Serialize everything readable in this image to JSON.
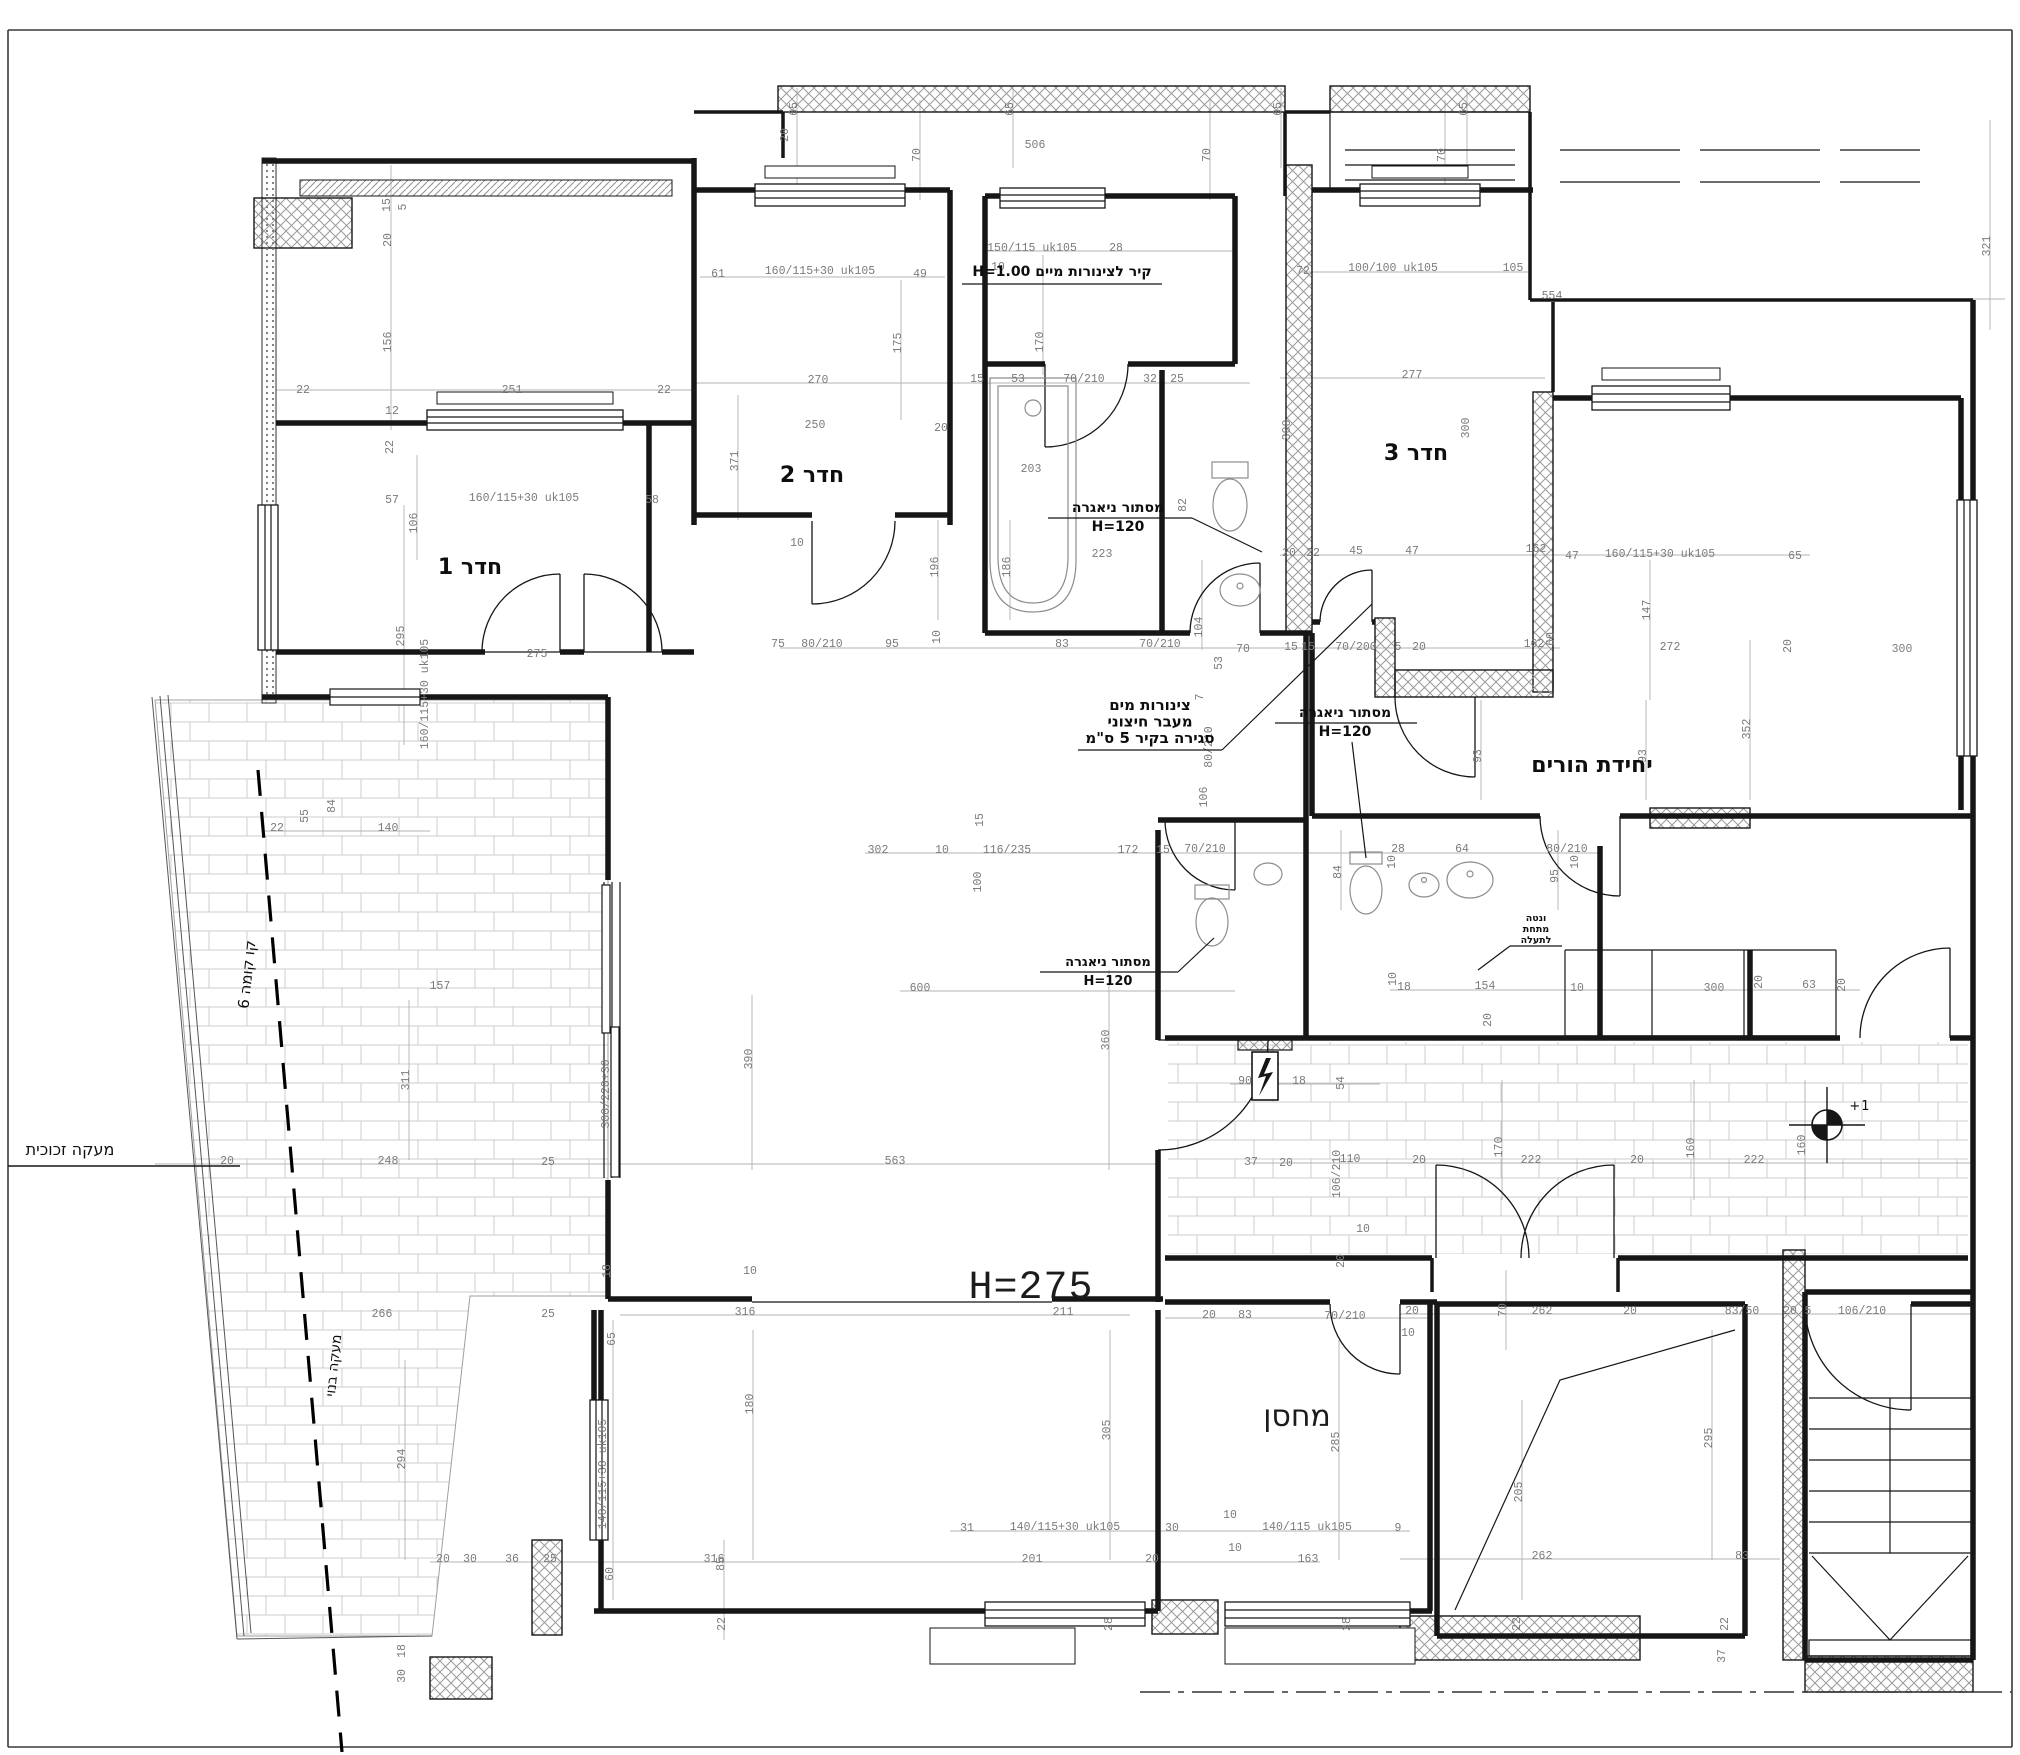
{
  "canvas": {
    "width": 2020,
    "height": 1755,
    "background": "#ffffff"
  },
  "colors": {
    "wall": "#161616",
    "dimension_text": "#7b7b7b",
    "hatch": "#9a9a9a",
    "tile": "#cccccc",
    "note_text": "#0e0e0e",
    "guide_line": "#b3b3b3"
  },
  "room_labels": [
    {
      "text": "חדר 1",
      "x": 470,
      "y": 574,
      "size": 22
    },
    {
      "text": "חדר 2",
      "x": 812,
      "y": 482,
      "size": 22
    },
    {
      "text": "חדר 3",
      "x": 1416,
      "y": 460,
      "size": 22
    },
    {
      "text": "יחידת הורים",
      "x": 1592,
      "y": 772,
      "size": 22
    },
    {
      "text": "מחסן",
      "x": 1297,
      "y": 1426,
      "size": 30,
      "light": true
    },
    {
      "text": "H=275",
      "x": 1031,
      "y": 1298,
      "size": 40,
      "light": true,
      "mono": true
    }
  ],
  "notes": [
    {
      "lines": [
        "קיר לצינורות מיים H=1.00"
      ],
      "x": 1062,
      "y": 276,
      "lh": 17,
      "size": 14,
      "bold": true,
      "underline": [
        962,
        284,
        1162,
        284
      ]
    },
    {
      "lines": [
        "מסתור ניאגרה",
        "H=120"
      ],
      "x": 1118,
      "y": 512,
      "lh": 19,
      "size": 14,
      "bold": true,
      "underline": [
        1048,
        518,
        1192,
        518
      ],
      "leader": [
        1192,
        518,
        1262,
        552
      ]
    },
    {
      "lines": [
        "מסתור ניאגרה",
        "H=120"
      ],
      "x": 1345,
      "y": 717,
      "lh": 19,
      "size": 14,
      "bold": true,
      "underline": [
        1275,
        723,
        1417,
        723
      ],
      "leader": [
        1352,
        742,
        1366,
        858
      ]
    },
    {
      "lines": [
        "מסתור ניאגרה",
        "H=120"
      ],
      "x": 1108,
      "y": 966,
      "lh": 19,
      "size": 13,
      "bold": true,
      "underline": [
        1040,
        972,
        1178,
        972
      ],
      "leader": [
        1178,
        972,
        1214,
        938
      ]
    },
    {
      "lines": [
        "צינורות מים",
        "מעבר חיצוני",
        "סגירה בקיר 5 ס\"מ"
      ],
      "x": 1150,
      "y": 710,
      "lh": 16.5,
      "size": 15,
      "bold": true,
      "underline": [
        1078,
        750,
        1222,
        750
      ],
      "leader": [
        1222,
        750,
        1372,
        604
      ]
    },
    {
      "lines": [
        "ונטה",
        "מתחת",
        "לתעלה"
      ],
      "x": 1536,
      "y": 921,
      "lh": 11,
      "size": 9.5,
      "bold": true,
      "underline": [
        1510,
        946,
        1562,
        946
      ],
      "leader": [
        1510,
        946,
        1478,
        970
      ]
    },
    {
      "lines": [
        "מעקה זכוכית"
      ],
      "x": 70,
      "y": 1155,
      "lh": 17,
      "size": 16
    },
    {
      "lines": [
        "קו קומה 6"
      ],
      "x": 252,
      "y": 975,
      "lh": 16,
      "size": 15,
      "rot": -84
    },
    {
      "lines": [
        "מעקה בנוי"
      ],
      "x": 338,
      "y": 1366,
      "lh": 15,
      "size": 14,
      "rot": -84
    },
    {
      "lines": [
        "+1"
      ],
      "x": 1860,
      "y": 1110,
      "lh": 14,
      "size": 13,
      "mono": true
    }
  ],
  "dimensions": [
    {
      "t": "15",
      "x": 390,
      "y": 205,
      "r": -90
    },
    {
      "t": "5",
      "x": 406,
      "y": 207,
      "r": -90
    },
    {
      "t": "20",
      "x": 391,
      "y": 240,
      "r": -90
    },
    {
      "t": "156",
      "x": 391,
      "y": 342,
      "r": -90
    },
    {
      "t": "22",
      "x": 303,
      "y": 393
    },
    {
      "t": "251",
      "x": 512,
      "y": 393
    },
    {
      "t": "22",
      "x": 664,
      "y": 393
    },
    {
      "t": "12",
      "x": 392,
      "y": 414
    },
    {
      "t": "22",
      "x": 393,
      "y": 447,
      "r": -90
    },
    {
      "t": "57",
      "x": 392,
      "y": 503
    },
    {
      "t": "160/115+30 uk105",
      "x": 524,
      "y": 501
    },
    {
      "t": "58",
      "x": 652,
      "y": 503
    },
    {
      "t": "106",
      "x": 417,
      "y": 523,
      "r": -90
    },
    {
      "t": "295",
      "x": 404,
      "y": 636,
      "r": -90
    },
    {
      "t": "160/115+30 uk105",
      "x": 428,
      "y": 694,
      "r": -90
    },
    {
      "t": "275",
      "x": 537,
      "y": 657
    },
    {
      "t": "22",
      "x": 277,
      "y": 831
    },
    {
      "t": "55",
      "x": 308,
      "y": 816,
      "r": -90
    },
    {
      "t": "84",
      "x": 335,
      "y": 806,
      "r": -90
    },
    {
      "t": "140",
      "x": 388,
      "y": 831
    },
    {
      "t": "65",
      "x": 797,
      "y": 109,
      "r": -90
    },
    {
      "t": "65",
      "x": 1013,
      "y": 109,
      "r": -90
    },
    {
      "t": "65",
      "x": 1281,
      "y": 109,
      "r": -90
    },
    {
      "t": "65",
      "x": 1467,
      "y": 109,
      "r": -90
    },
    {
      "t": "506",
      "x": 1035,
      "y": 148
    },
    {
      "t": "70",
      "x": 920,
      "y": 155,
      "r": -90
    },
    {
      "t": "70",
      "x": 1210,
      "y": 155,
      "r": -90
    },
    {
      "t": "70",
      "x": 1445,
      "y": 155,
      "r": -90
    },
    {
      "t": "20",
      "x": 788,
      "y": 135,
      "r": -90
    },
    {
      "t": "554",
      "x": 1552,
      "y": 299
    },
    {
      "t": "321",
      "x": 1990,
      "y": 246,
      "r": -90
    },
    {
      "t": "61",
      "x": 718,
      "y": 277
    },
    {
      "t": "160/115+30 uk105",
      "x": 820,
      "y": 274
    },
    {
      "t": "49",
      "x": 920,
      "y": 277
    },
    {
      "t": "175",
      "x": 901,
      "y": 343,
      "r": -90
    },
    {
      "t": "270",
      "x": 818,
      "y": 383
    },
    {
      "t": "250",
      "x": 815,
      "y": 428
    },
    {
      "t": "20",
      "x": 941,
      "y": 431
    },
    {
      "t": "371",
      "x": 738,
      "y": 461,
      "r": -90
    },
    {
      "t": "196",
      "x": 938,
      "y": 567,
      "r": -90
    },
    {
      "t": "10",
      "x": 797,
      "y": 546
    },
    {
      "t": "150/115 uk105",
      "x": 1032,
      "y": 251
    },
    {
      "t": "28",
      "x": 1116,
      "y": 251
    },
    {
      "t": "10",
      "x": 998,
      "y": 270
    },
    {
      "t": "170",
      "x": 1043,
      "y": 342,
      "r": -90
    },
    {
      "t": "15",
      "x": 977,
      "y": 382
    },
    {
      "t": "53",
      "x": 1018,
      "y": 382
    },
    {
      "t": "70/210",
      "x": 1084,
      "y": 382
    },
    {
      "t": "32",
      "x": 1150,
      "y": 382
    },
    {
      "t": "25",
      "x": 1177,
      "y": 382
    },
    {
      "t": "203",
      "x": 1031,
      "y": 472
    },
    {
      "t": "223",
      "x": 1102,
      "y": 557
    },
    {
      "t": "186",
      "x": 1010,
      "y": 567,
      "r": -90
    },
    {
      "t": "82",
      "x": 1186,
      "y": 505,
      "r": -90
    },
    {
      "t": "75",
      "x": 778,
      "y": 647
    },
    {
      "t": "80/210",
      "x": 822,
      "y": 647
    },
    {
      "t": "95",
      "x": 892,
      "y": 647
    },
    {
      "t": "10",
      "x": 940,
      "y": 637,
      "r": -90
    },
    {
      "t": "83",
      "x": 1062,
      "y": 647
    },
    {
      "t": "70/210",
      "x": 1160,
      "y": 647
    },
    {
      "t": "104",
      "x": 1202,
      "y": 627,
      "r": -90
    },
    {
      "t": "70",
      "x": 1243,
      "y": 652
    },
    {
      "t": "72",
      "x": 1303,
      "y": 274
    },
    {
      "t": "100/100 uk105",
      "x": 1393,
      "y": 271
    },
    {
      "t": "105",
      "x": 1513,
      "y": 271
    },
    {
      "t": "277",
      "x": 1412,
      "y": 378
    },
    {
      "t": "300",
      "x": 1290,
      "y": 430,
      "r": -90
    },
    {
      "t": "300",
      "x": 1469,
      "y": 428,
      "r": -90
    },
    {
      "t": "20",
      "x": 1289,
      "y": 556
    },
    {
      "t": "22",
      "x": 1313,
      "y": 556
    },
    {
      "t": "45",
      "x": 1356,
      "y": 554
    },
    {
      "t": "47",
      "x": 1412,
      "y": 554
    },
    {
      "t": "162",
      "x": 1536,
      "y": 552
    },
    {
      "t": "15",
      "x": 1291,
      "y": 650
    },
    {
      "t": "15",
      "x": 1308,
      "y": 650
    },
    {
      "t": "70/200",
      "x": 1356,
      "y": 650
    },
    {
      "t": "5",
      "x": 1398,
      "y": 650
    },
    {
      "t": "20",
      "x": 1419,
      "y": 650
    },
    {
      "t": "162",
      "x": 1534,
      "y": 647
    },
    {
      "t": "60",
      "x": 1554,
      "y": 639,
      "r": -90
    },
    {
      "t": "53",
      "x": 1222,
      "y": 663,
      "r": -90
    },
    {
      "t": "7",
      "x": 1203,
      "y": 697,
      "r": -90
    },
    {
      "t": "80/210",
      "x": 1212,
      "y": 747,
      "r": -90
    },
    {
      "t": "106",
      "x": 1207,
      "y": 797,
      "r": -90
    },
    {
      "t": "47",
      "x": 1572,
      "y": 559
    },
    {
      "t": "160/115+30 uk105",
      "x": 1660,
      "y": 557
    },
    {
      "t": "65",
      "x": 1795,
      "y": 559
    },
    {
      "t": "147",
      "x": 1650,
      "y": 610,
      "r": -90
    },
    {
      "t": "272",
      "x": 1670,
      "y": 650
    },
    {
      "t": "20",
      "x": 1791,
      "y": 646,
      "r": -90
    },
    {
      "t": "352",
      "x": 1750,
      "y": 729,
      "r": -90
    },
    {
      "t": "93",
      "x": 1481,
      "y": 756,
      "r": -90
    },
    {
      "t": "93",
      "x": 1646,
      "y": 756,
      "r": -90
    },
    {
      "t": "300",
      "x": 1902,
      "y": 652
    },
    {
      "t": "15",
      "x": 983,
      "y": 820,
      "r": -90
    },
    {
      "t": "100",
      "x": 981,
      "y": 882,
      "r": -90
    },
    {
      "t": "302",
      "x": 878,
      "y": 853
    },
    {
      "t": "10",
      "x": 942,
      "y": 853
    },
    {
      "t": "116/235",
      "x": 1007,
      "y": 853
    },
    {
      "t": "172",
      "x": 1128,
      "y": 853
    },
    {
      "t": "15",
      "x": 1163,
      "y": 853
    },
    {
      "t": "70/210",
      "x": 1205,
      "y": 852
    },
    {
      "t": "28",
      "x": 1398,
      "y": 852
    },
    {
      "t": "64",
      "x": 1462,
      "y": 852
    },
    {
      "t": "80/210",
      "x": 1567,
      "y": 852
    },
    {
      "t": "84",
      "x": 1341,
      "y": 872,
      "r": -90
    },
    {
      "t": "95",
      "x": 1558,
      "y": 876,
      "r": -90
    },
    {
      "t": "10",
      "x": 1395,
      "y": 862,
      "r": -90
    },
    {
      "t": "10",
      "x": 1578,
      "y": 862,
      "r": -90
    },
    {
      "t": "90",
      "x": 1245,
      "y": 1084
    },
    {
      "t": "18",
      "x": 1299,
      "y": 1084
    },
    {
      "t": "54",
      "x": 1344,
      "y": 1083,
      "r": -90
    },
    {
      "t": "18",
      "x": 1404,
      "y": 990
    },
    {
      "t": "154",
      "x": 1485,
      "y": 989
    },
    {
      "t": "10",
      "x": 1396,
      "y": 979,
      "r": -90
    },
    {
      "t": "20",
      "x": 1491,
      "y": 1020,
      "r": -90
    },
    {
      "t": "10",
      "x": 1577,
      "y": 991
    },
    {
      "t": "300",
      "x": 1714,
      "y": 991
    },
    {
      "t": "63",
      "x": 1809,
      "y": 988
    },
    {
      "t": "20",
      "x": 1845,
      "y": 985,
      "r": -90
    },
    {
      "t": "20",
      "x": 1762,
      "y": 982,
      "r": -90
    },
    {
      "t": "110",
      "x": 1350,
      "y": 1162
    },
    {
      "t": "20",
      "x": 1419,
      "y": 1163
    },
    {
      "t": "222",
      "x": 1531,
      "y": 1163
    },
    {
      "t": "20",
      "x": 1637,
      "y": 1163
    },
    {
      "t": "222",
      "x": 1754,
      "y": 1163
    },
    {
      "t": "160",
      "x": 1694,
      "y": 1148,
      "r": -90
    },
    {
      "t": "160",
      "x": 1805,
      "y": 1145,
      "r": -90
    },
    {
      "t": "170",
      "x": 1502,
      "y": 1147,
      "r": -90
    },
    {
      "t": "37",
      "x": 1251,
      "y": 1165
    },
    {
      "t": "20",
      "x": 1286,
      "y": 1166
    },
    {
      "t": "106/210",
      "x": 1340,
      "y": 1174,
      "r": -90
    },
    {
      "t": "10",
      "x": 1363,
      "y": 1232
    },
    {
      "t": "20",
      "x": 1344,
      "y": 1261,
      "r": -90
    },
    {
      "t": "600",
      "x": 920,
      "y": 991
    },
    {
      "t": "390",
      "x": 752,
      "y": 1059,
      "r": -90
    },
    {
      "t": "563",
      "x": 895,
      "y": 1164
    },
    {
      "t": "360",
      "x": 1109,
      "y": 1040,
      "r": -90
    },
    {
      "t": "316",
      "x": 745,
      "y": 1315
    },
    {
      "t": "211",
      "x": 1063,
      "y": 1315
    },
    {
      "t": "18",
      "x": 610,
      "y": 1271,
      "r": -90
    },
    {
      "t": "10",
      "x": 750,
      "y": 1274
    },
    {
      "t": "25",
      "x": 548,
      "y": 1165
    },
    {
      "t": "25",
      "x": 548,
      "y": 1317
    },
    {
      "t": "65",
      "x": 615,
      "y": 1339,
      "r": -90
    },
    {
      "t": "60",
      "x": 613,
      "y": 1574,
      "r": -90
    },
    {
      "t": "300/220+30",
      "x": 609,
      "y": 1094,
      "r": -90
    },
    {
      "t": "180",
      "x": 753,
      "y": 1404,
      "r": -90
    },
    {
      "t": "305",
      "x": 1110,
      "y": 1430,
      "r": -90
    },
    {
      "t": "316",
      "x": 714,
      "y": 1562
    },
    {
      "t": "85",
      "x": 724,
      "y": 1564,
      "r": -90
    },
    {
      "t": "140/115+30 uk105",
      "x": 606,
      "y": 1474,
      "r": -90
    },
    {
      "t": "22",
      "x": 725,
      "y": 1624,
      "r": -90
    },
    {
      "t": "31",
      "x": 967,
      "y": 1531
    },
    {
      "t": "140/115+30 uk105",
      "x": 1065,
      "y": 1530
    },
    {
      "t": "30",
      "x": 1172,
      "y": 1531
    },
    {
      "t": "10",
      "x": 1230,
      "y": 1518
    },
    {
      "t": "140/115 uk105",
      "x": 1307,
      "y": 1530
    },
    {
      "t": "9",
      "x": 1398,
      "y": 1531
    },
    {
      "t": "201",
      "x": 1032,
      "y": 1562
    },
    {
      "t": "20",
      "x": 1152,
      "y": 1562
    },
    {
      "t": "163",
      "x": 1308,
      "y": 1562
    },
    {
      "t": "10",
      "x": 1235,
      "y": 1551
    },
    {
      "t": "28",
      "x": 1112,
      "y": 1624,
      "r": -90
    },
    {
      "t": "28",
      "x": 1350,
      "y": 1624,
      "r": -90
    },
    {
      "t": "20",
      "x": 1209,
      "y": 1318
    },
    {
      "t": "83",
      "x": 1245,
      "y": 1318
    },
    {
      "t": "70/210",
      "x": 1345,
      "y": 1319
    },
    {
      "t": "285",
      "x": 1339,
      "y": 1442,
      "r": -90
    },
    {
      "t": "157",
      "x": 440,
      "y": 989
    },
    {
      "t": "311",
      "x": 409,
      "y": 1080,
      "r": -90
    },
    {
      "t": "248",
      "x": 388,
      "y": 1164
    },
    {
      "t": "20",
      "x": 227,
      "y": 1164
    },
    {
      "t": "266",
      "x": 382,
      "y": 1317
    },
    {
      "t": "294",
      "x": 405,
      "y": 1459,
      "r": -90
    },
    {
      "t": "20",
      "x": 443,
      "y": 1562
    },
    {
      "t": "30",
      "x": 470,
      "y": 1562
    },
    {
      "t": "36",
      "x": 512,
      "y": 1562
    },
    {
      "t": "25",
      "x": 550,
      "y": 1562
    },
    {
      "t": "18",
      "x": 405,
      "y": 1651,
      "r": -90
    },
    {
      "t": "30",
      "x": 405,
      "y": 1676,
      "r": -90
    },
    {
      "t": "20",
      "x": 1412,
      "y": 1314
    },
    {
      "t": "70",
      "x": 1506,
      "y": 1310,
      "r": -90
    },
    {
      "t": "262",
      "x": 1542,
      "y": 1314
    },
    {
      "t": "20",
      "x": 1630,
      "y": 1314
    },
    {
      "t": "83/50",
      "x": 1742,
      "y": 1314
    },
    {
      "t": "20",
      "x": 1790,
      "y": 1314
    },
    {
      "t": "5",
      "x": 1808,
      "y": 1314
    },
    {
      "t": "106/210",
      "x": 1862,
      "y": 1314
    },
    {
      "t": "295",
      "x": 1712,
      "y": 1438,
      "r": -90
    },
    {
      "t": "205",
      "x": 1522,
      "y": 1492,
      "r": -90
    },
    {
      "t": "262",
      "x": 1542,
      "y": 1559
    },
    {
      "t": "83",
      "x": 1742,
      "y": 1559
    },
    {
      "t": "22",
      "x": 1520,
      "y": 1624,
      "r": -90
    },
    {
      "t": "22",
      "x": 1728,
      "y": 1624,
      "r": -90
    },
    {
      "t": "37",
      "x": 1725,
      "y": 1656,
      "r": -90
    },
    {
      "t": "10",
      "x": 1408,
      "y": 1336
    }
  ]
}
